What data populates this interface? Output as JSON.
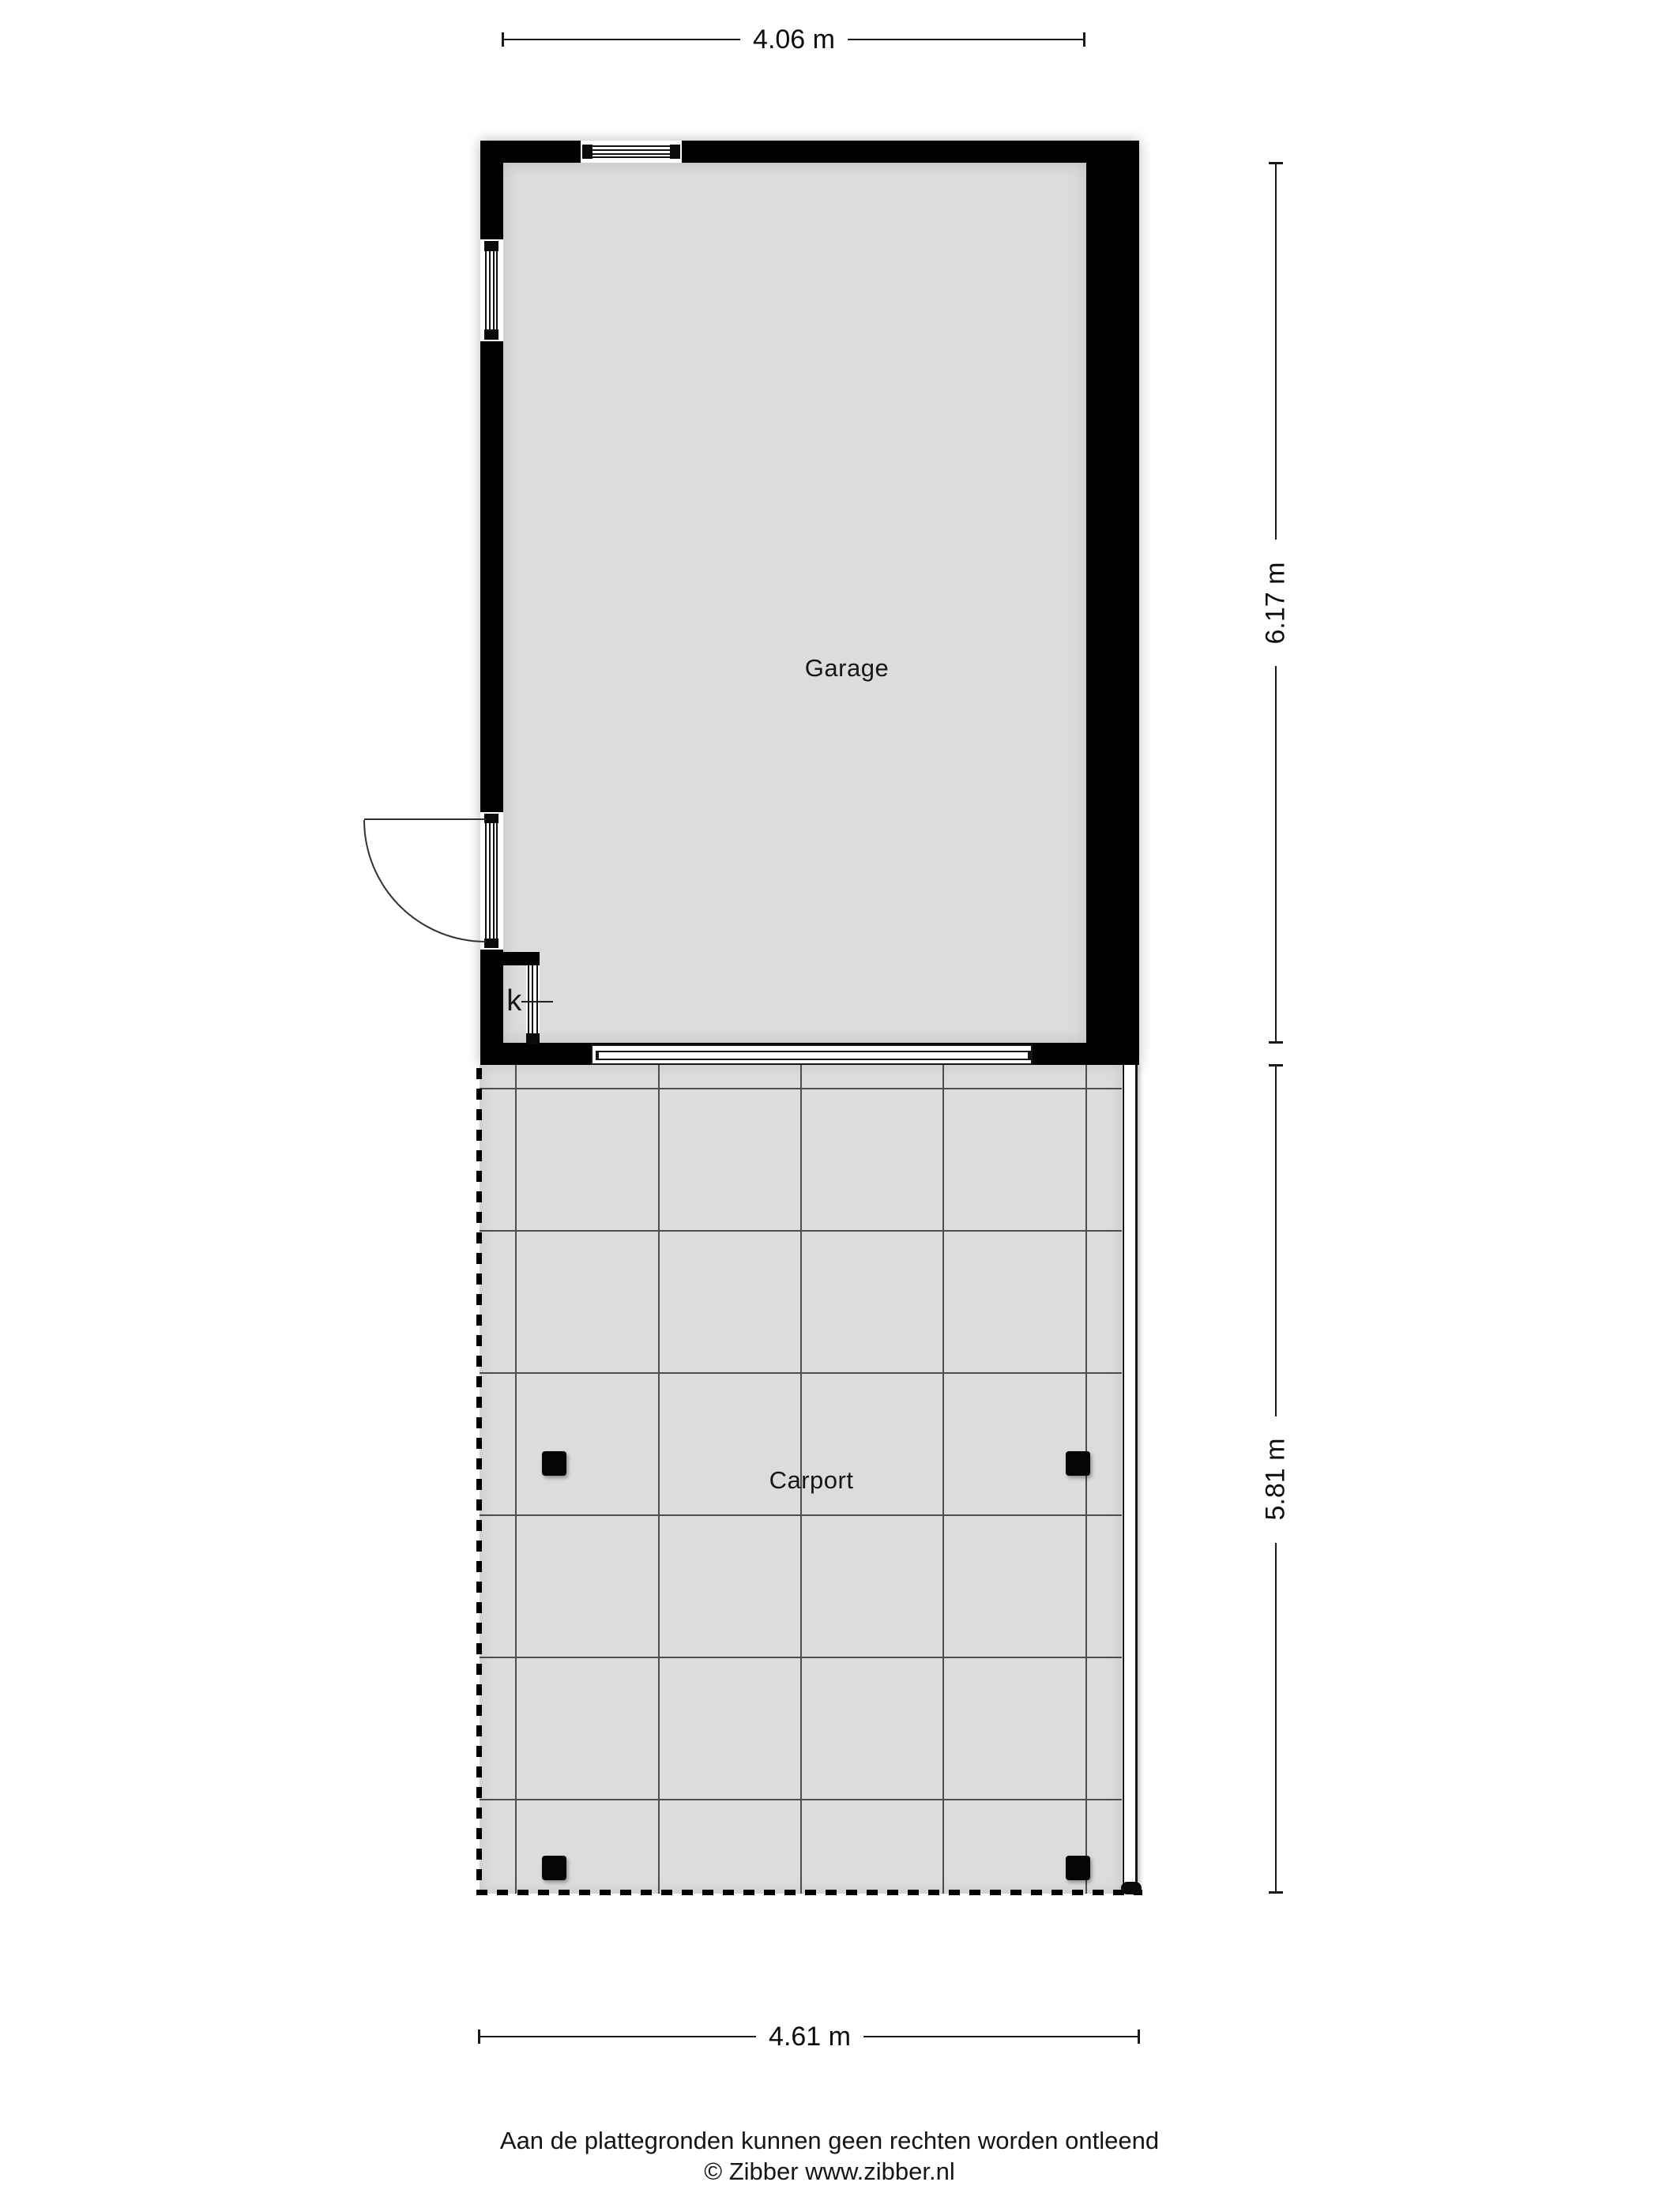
{
  "rooms": {
    "garage": {
      "label": "Garage"
    },
    "carport": {
      "label": "Carport"
    },
    "closet": {
      "label": "k"
    }
  },
  "dimensions": {
    "garage_width": "4.06 m",
    "garage_height": "6.17 m",
    "carport_height": "5.81 m",
    "carport_width": "4.61 m"
  },
  "footer": {
    "disclaimer": "Aan de plattegronden kunnen geen rechten worden ontleend",
    "copyright": "© Zibber www.zibber.nl"
  },
  "colors": {
    "wall": "#000000",
    "floor": "#dcdcdc",
    "grid_line": "#4d4d4d",
    "dimension_line": "#1a1a1a",
    "background": "#ffffff"
  }
}
